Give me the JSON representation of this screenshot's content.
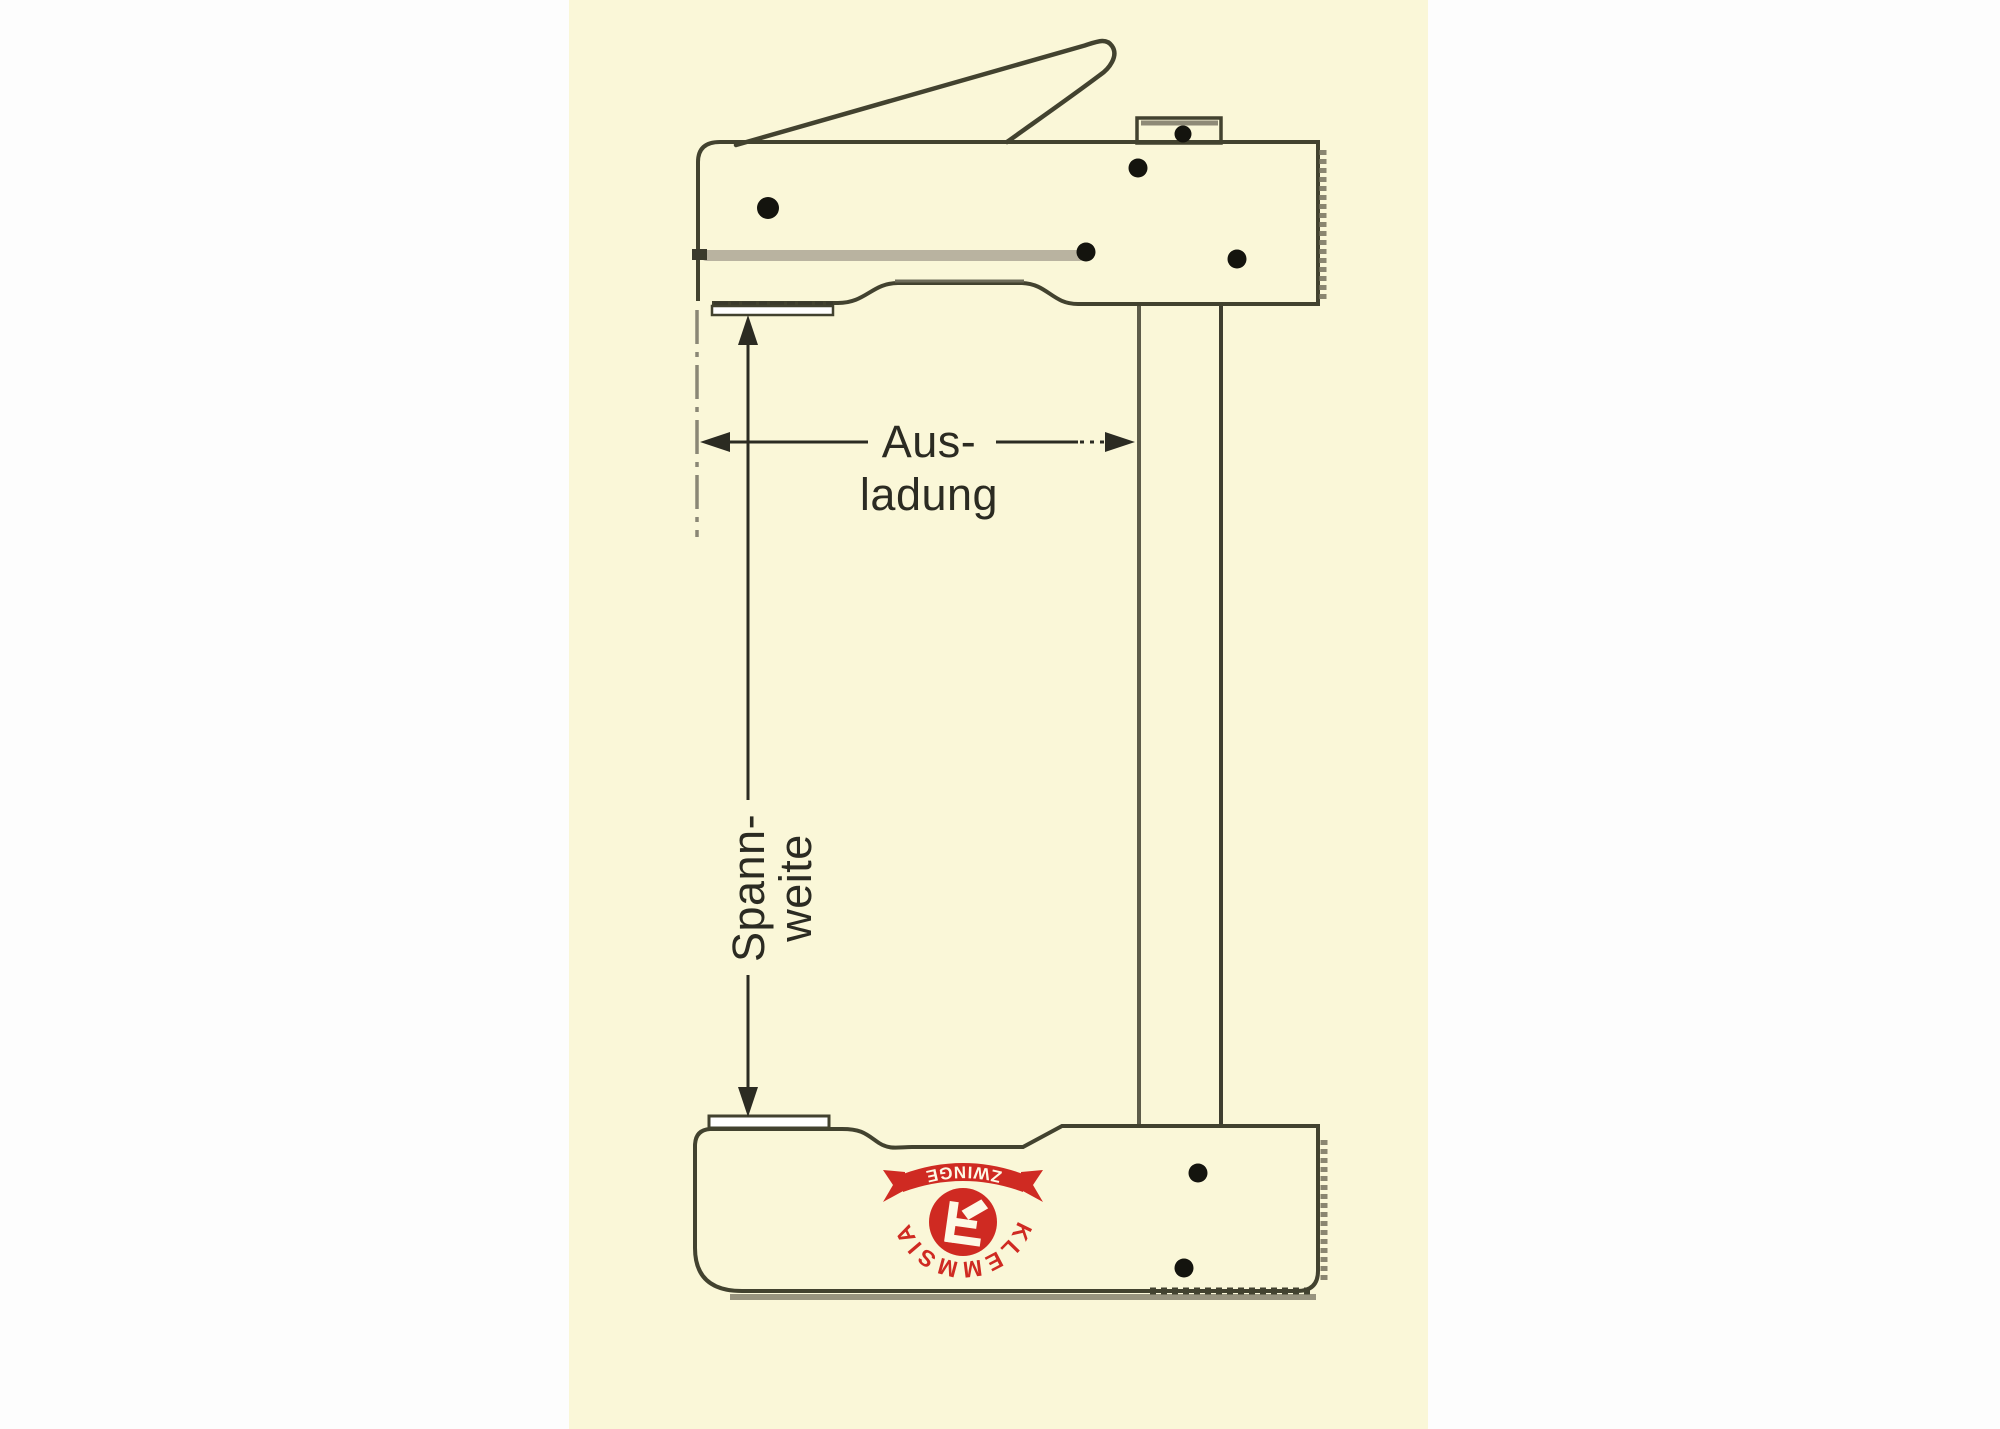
{
  "title": "Klemmsia Zwinge F-clamp dimension diagram",
  "labels": {
    "ausladung_line1": "Aus-",
    "ausladung_line2": "ladung",
    "spannweite_line1": "Spann-",
    "spannweite_line2": "weite"
  },
  "logo": {
    "brand": "KLEMMSIA",
    "product": "ZWINGE"
  },
  "colors": {
    "page_background": "#fdfdfd",
    "panel_background": "#faf7d8",
    "outline": "#42422f",
    "shelf_gray": "#6e6c5a",
    "dimension_line": "#2b2b22",
    "extension_gray": "#8a8775",
    "slot_gray": "#b9b3a0",
    "shadow_gray": "#98947f",
    "pad_white": "#ffffff",
    "rivet_black": "#14140e",
    "logo_red": "#cf2a22"
  }
}
